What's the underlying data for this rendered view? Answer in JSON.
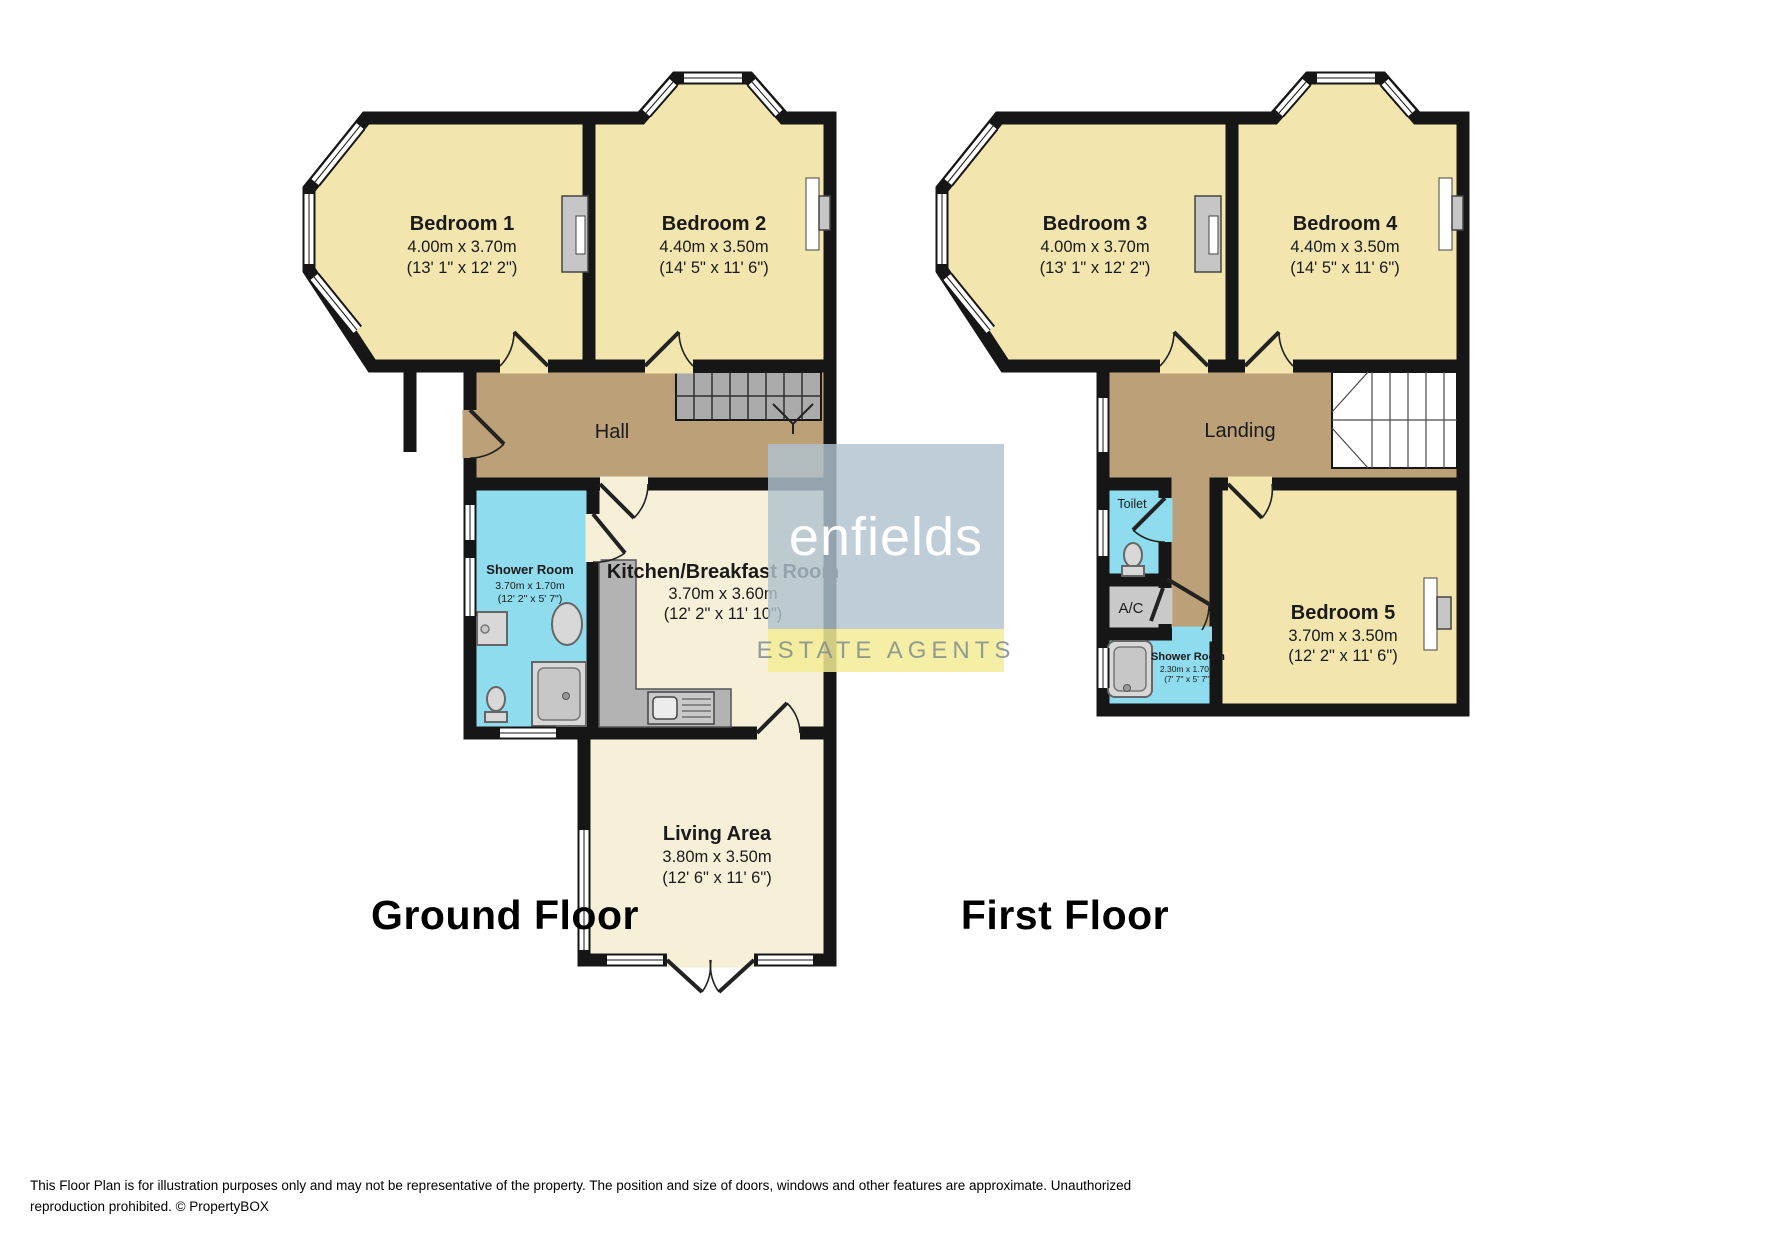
{
  "floors": [
    {
      "title": "Ground Floor",
      "rooms": [
        {
          "name": "Bedroom 1",
          "metric": "4.00m x 3.70m",
          "imperial": "(13' 1\" x 12' 2\")"
        },
        {
          "name": "Bedroom 2",
          "metric": "4.40m x 3.50m",
          "imperial": "(14' 5\" x 11' 6\")"
        },
        {
          "name": "Hall"
        },
        {
          "name": "Shower Room",
          "metric": "3.70m x 1.70m",
          "imperial": "(12' 2\" x 5' 7\")"
        },
        {
          "name": "Kitchen/Breakfast Room",
          "metric": "3.70m x 3.60m",
          "imperial": "(12' 2\" x 11' 10\")"
        },
        {
          "name": "Living Area",
          "metric": "3.80m x 3.50m",
          "imperial": "(12' 6\" x 11' 6\")"
        }
      ]
    },
    {
      "title": "First Floor",
      "rooms": [
        {
          "name": "Bedroom 3",
          "metric": "4.00m x 3.70m",
          "imperial": "(13' 1\" x 12' 2\")"
        },
        {
          "name": "Bedroom 4",
          "metric": "4.40m x 3.50m",
          "imperial": "(14' 5\" x 11' 6\")"
        },
        {
          "name": "Landing"
        },
        {
          "name": "Toilet"
        },
        {
          "name": "A/C"
        },
        {
          "name": "Shower Room",
          "metric": "2.30m x 1.70m",
          "imperial": "(7' 7\" x 5' 7\")"
        },
        {
          "name": "Bedroom 5",
          "metric": "3.70m x 3.50m",
          "imperial": "(12' 2\" x 11' 6\")"
        }
      ]
    }
  ],
  "watermark": {
    "brand": "enfields",
    "tagline": "ESTATE AGENTS"
  },
  "disclaimer": "This Floor Plan is for illustration purposes only and may not be representative of the property. The position and size of doors, windows and other features are approximate. Unauthorized reproduction prohibited. © PropertyBOX",
  "palette": {
    "wall": "#161616",
    "bedroom_fill": "#f2e5ad",
    "hall_fill": "#bca077",
    "wet_room_fill": "#8edcee",
    "kitchen_fill": "#f6f0d8",
    "stairs_fill": "#ababab",
    "counter_fill": "#b3b3b3",
    "fixture_fill": "#d8d8d8",
    "watermark_blue": "#b0c2ce",
    "watermark_yellow": "#f3ec96"
  }
}
